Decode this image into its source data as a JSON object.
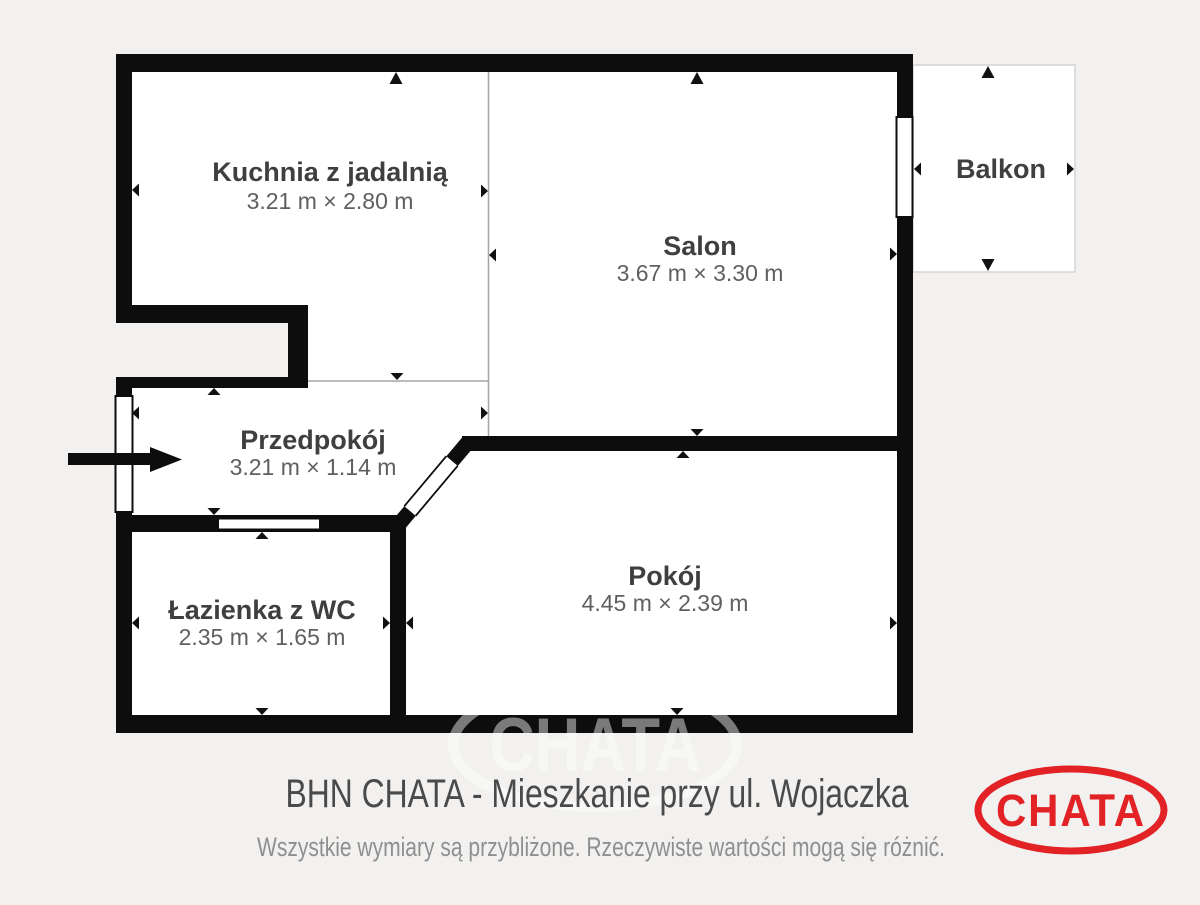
{
  "theme": {
    "background": "#f2f1ef",
    "wall_color": "#0d0d0d",
    "room_fill": "#ffffff",
    "divider_line": "#a6a6a6",
    "balcony_border": "#d4d4d4",
    "label_color": "#3f3f3f",
    "dims_color": "#5f5f5f",
    "accent_red": "#e32226"
  },
  "rooms": {
    "kuchnia": {
      "name": "Kuchnia z jadalnią",
      "dims": "3.21 m × 2.80 m"
    },
    "salon": {
      "name": "Salon",
      "dims": "3.67 m × 3.30 m"
    },
    "balkon": {
      "name": "Balkon"
    },
    "przedpokoj": {
      "name": "Przedpokój",
      "dims": "3.21 m × 1.14 m"
    },
    "lazienka": {
      "name": "Łazienka z WC",
      "dims": "2.35 m × 1.65 m"
    },
    "pokoj": {
      "name": "Pokój",
      "dims": "4.45 m × 2.39 m"
    }
  },
  "footer": {
    "title": "BHN CHATA - Mieszkanie przy ul. Wojaczka",
    "disclaimer": "Wszystkie wymiary są przybliżone. Rzeczywiste wartości mogą się różnić."
  },
  "logo": {
    "text": "CHATA"
  },
  "watermark": {
    "text": "CHATA"
  }
}
